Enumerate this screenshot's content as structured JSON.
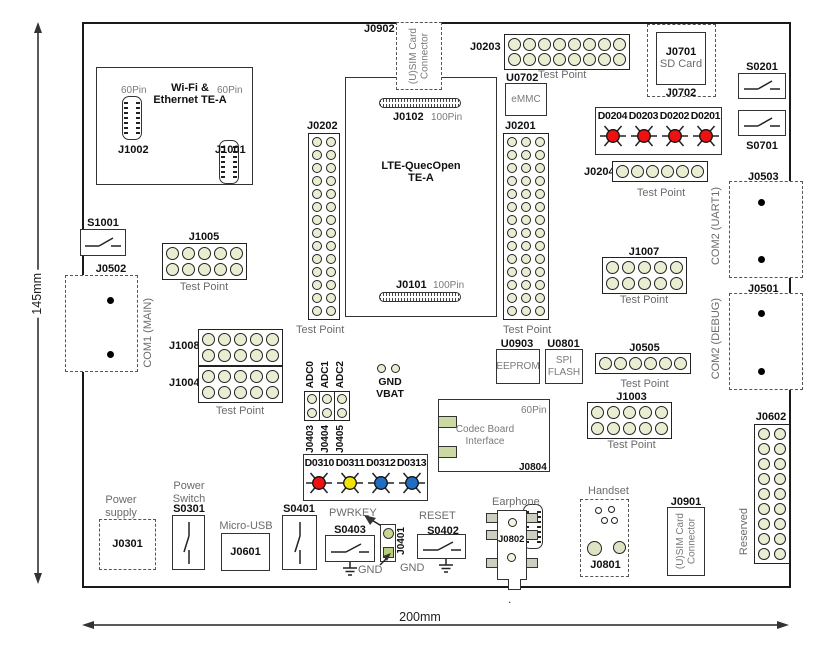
{
  "dims": {
    "h": "145mm",
    "w": "200mm",
    "dot": "."
  },
  "wifi": {
    "title": "Wi-Fi &\nEthernet TE-A",
    "pins_left": "60Pin",
    "pins_right": "60Pin",
    "ref_left": "J1002",
    "ref_right": "J1001"
  },
  "s1001": {
    "ref": "S1001"
  },
  "com1": {
    "ref": "J0502",
    "label": "COM1 (MAIN)"
  },
  "sim_top": {
    "ref": "J0902",
    "label": "(U)SIM Card\nConnector"
  },
  "lte": {
    "title": "LTE-QuecOpen\nTE-A",
    "top_ref": "J0102",
    "top_pins": "100Pin",
    "bot_ref": "J0101",
    "bot_pins": "100Pin"
  },
  "tp": {
    "j0202": {
      "ref": "J0202",
      "caption": "Test Point",
      "rows": 14,
      "cols": 2
    },
    "j0201": {
      "ref": "J0201",
      "caption": "Test Point",
      "rows": 14,
      "cols": 3
    },
    "j0203": {
      "ref": "J0203",
      "caption": "Test Point",
      "rows": 2,
      "cols": 8
    },
    "j0204": {
      "ref": "J0204",
      "caption": "Test Point",
      "rows": 1,
      "cols": 6
    },
    "j1005": {
      "ref": "J1005",
      "caption": "Test Point",
      "rows": 2,
      "cols": 5
    },
    "j1008": {
      "ref": "J1008",
      "rows": 2,
      "cols": 5
    },
    "j1004": {
      "ref": "J1004",
      "caption": "Test Point",
      "rows": 2,
      "cols": 5
    },
    "j1007": {
      "ref": "J1007",
      "caption": "Test Point",
      "rows": 2,
      "cols": 5
    },
    "j0505": {
      "ref": "J0505",
      "caption": "Test Point",
      "rows": 1,
      "cols": 6
    },
    "j1003": {
      "ref": "J1003",
      "caption": "Test Point",
      "rows": 2,
      "cols": 5
    },
    "j0602": {
      "ref": "J0602",
      "rows": 9,
      "cols": 2
    }
  },
  "emmc": {
    "ref": "U0702",
    "label": "eMMC"
  },
  "sd": {
    "ref": "J0701",
    "label": "SD Card",
    "outer_ref": "J0702"
  },
  "s0201": {
    "ref": "S0201"
  },
  "s0701": {
    "ref": "S0701"
  },
  "leds_top": {
    "labels": [
      "D0204",
      "D0203",
      "D0202",
      "D0201"
    ],
    "colors": [
      "#ee1111",
      "#ee1111",
      "#ee1111",
      "#ee1111"
    ]
  },
  "com2_uart1": {
    "ref": "J0503",
    "label": "COM2 (UART1)"
  },
  "com2_debug": {
    "ref": "J0501",
    "label": "COM2 (DEBUG)"
  },
  "eeprom": {
    "ref": "U0903",
    "label": "EEPROM"
  },
  "spi_flash": {
    "ref": "U0801",
    "label": "SPI\nFLASH"
  },
  "adc": {
    "tops": [
      "ADC0",
      "ADC1",
      "ADC2"
    ],
    "bottoms": [
      "J0403",
      "J0404",
      "J0405"
    ],
    "jumper": {
      "rows": 2,
      "cols": 1
    }
  },
  "gnd_vbat": {
    "label": "GND VBAT"
  },
  "leds_bottom": {
    "labels": [
      "D0310",
      "D0311",
      "D0312",
      "D0313"
    ],
    "colors": [
      "#ee1111",
      "#f2e30c",
      "#1e6fc4",
      "#1e6fc4"
    ]
  },
  "codec": {
    "label": "Codec Board\nInterface",
    "pins": "60Pin",
    "ref": "J0804"
  },
  "power_supply": {
    "label": "Power\nsupply",
    "ref": "J0301"
  },
  "power_switch": {
    "label": "Power\nSwitch",
    "ref": "S0301"
  },
  "micro_usb": {
    "label": "Micro-USB",
    "ref": "J0601"
  },
  "s0401": {
    "ref": "S0401"
  },
  "pwrkey": {
    "label": "PWRKEY",
    "sw_ref": "S0403",
    "conn_ref": "J0401",
    "gnd": "GND"
  },
  "reset": {
    "label": "RESET",
    "sw_ref": "S0402",
    "gnd": "GND"
  },
  "earphone": {
    "label": "Earphone",
    "ref": "J0802"
  },
  "handset": {
    "label": "Handset",
    "ref": "J0801"
  },
  "sim_bottom": {
    "ref": "J0901",
    "label": "(U)SIM Card\nConnector"
  },
  "reserved": {
    "label": "Reserved"
  }
}
